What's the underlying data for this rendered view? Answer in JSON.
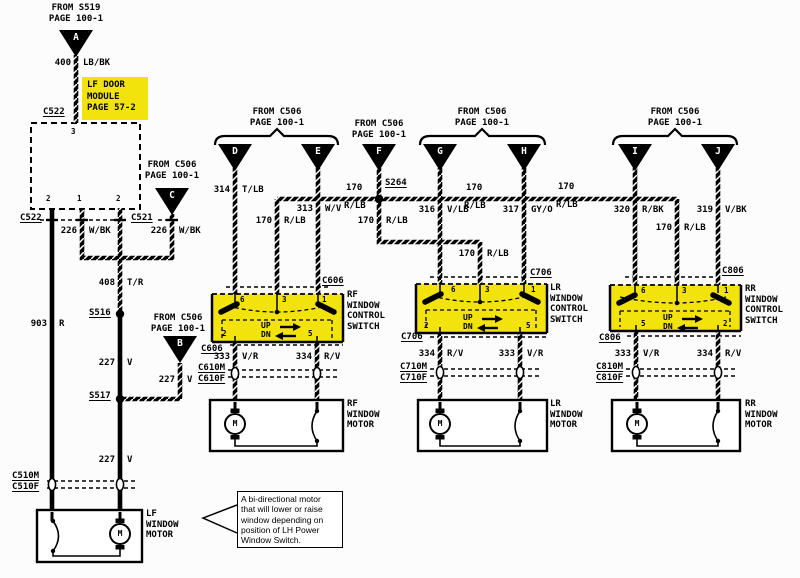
{
  "colors": {
    "highlight": "#F2E30D",
    "wire": "#000000",
    "background": "#fcfcfc"
  },
  "feeds": {
    "a": {
      "from": "FROM S519",
      "page": "PAGE 100-1",
      "letter": "A"
    },
    "c": {
      "from": "FROM C506",
      "page": "PAGE 100-1",
      "letter": "C"
    },
    "b": {
      "from": "FROM C506",
      "page": "PAGE 100-1",
      "letter": "B"
    },
    "de": {
      "from": "FROM C506",
      "page": "PAGE 100-1",
      "left": "D",
      "right": "E"
    },
    "f": {
      "from": "FROM C506",
      "page": "PAGE 100-1",
      "letter": "F"
    },
    "gh": {
      "from": "FROM C506",
      "page": "PAGE 100-1",
      "left": "G",
      "right": "H"
    },
    "ij": {
      "from": "FROM C506",
      "page": "PAGE 100-1",
      "left": "I",
      "right": "J"
    }
  },
  "module": {
    "line1": "LF DOOR",
    "line2": "MODULE",
    "line3": "PAGE 57-2",
    "conn_top": "C522",
    "pin_top": "3",
    "pin_b1": "2",
    "pin_b2": "1",
    "pin_b3": "2",
    "conn_bot_left": "C522",
    "conn_bot_right": "C521"
  },
  "splices": {
    "s516": "S516",
    "s517": "S517",
    "s264": "S264"
  },
  "wires": {
    "w400": {
      "num": "400",
      "code": "LB/BK"
    },
    "w226a": {
      "num": "226",
      "code": "W/BK"
    },
    "w226b": {
      "num": "226",
      "code": "W/BK"
    },
    "w408": {
      "num": "408",
      "code": "T/R"
    },
    "w903": {
      "num": "903",
      "code": "R"
    },
    "w227a": {
      "num": "227",
      "code": "V"
    },
    "w227b": {
      "num": "227",
      "code": "V"
    },
    "w227c": {
      "num": "227",
      "code": "V"
    },
    "w314": {
      "num": "314",
      "code": "T/LB"
    },
    "w313": {
      "num": "313",
      "code": "W/V"
    },
    "w170rf": {
      "num": "170",
      "code": "R/LB"
    },
    "w170s264l": {
      "num": "170",
      "code": "R/LB"
    },
    "w170s264d": {
      "num": "170",
      "code": "R/LB"
    },
    "w316": {
      "num": "316",
      "code": "V/LB"
    },
    "w170gh": {
      "num": "170",
      "code": "R/LB"
    },
    "w317": {
      "num": "317",
      "code": "GY/O"
    },
    "w170lr": {
      "num": "170",
      "code": "R/LB"
    },
    "w170hi": {
      "num": "170",
      "code": "R/LB"
    },
    "w320": {
      "num": "320",
      "code": "R/BK"
    },
    "w170rr": {
      "num": "170",
      "code": "R/LB"
    },
    "w319": {
      "num": "319",
      "code": "V/BK"
    },
    "w333rf": {
      "num": "333",
      "code": "V/R"
    },
    "w334rf": {
      "num": "334",
      "code": "R/V"
    },
    "w334lr": {
      "num": "334",
      "code": "R/V"
    },
    "w333lr": {
      "num": "333",
      "code": "V/R"
    },
    "w333rr": {
      "num": "333",
      "code": "V/R"
    },
    "w334rr": {
      "num": "334",
      "code": "R/V"
    }
  },
  "switches": {
    "rf": {
      "name1": "RF",
      "name2": "WINDOW",
      "name3": "CONTROL",
      "name4": "SWITCH",
      "conn_top": "C606",
      "conn_bot": "C606",
      "conn_m": "C610M",
      "conn_f": "C610F",
      "pins_top": [
        "6",
        "3",
        "1"
      ],
      "pin_bl": "2",
      "pin_br": "5",
      "up": "UP",
      "dn": "DN"
    },
    "lr": {
      "name1": "LR",
      "name2": "WINDOW",
      "name3": "CONTROL",
      "name4": "SWITCH",
      "conn_top": "C706",
      "conn_bot": "C706",
      "conn_m": "C710M",
      "conn_f": "C710F",
      "pins_top": [
        "6",
        "3",
        "1"
      ],
      "pin_bl": "2",
      "pin_br": "5",
      "up": "UP",
      "dn": "DN"
    },
    "rr": {
      "name1": "RR",
      "name2": "WINDOW",
      "name3": "CONTROL",
      "name4": "SWITCH",
      "conn_top": "C806",
      "conn_bot": "C806",
      "conn_m": "C810M",
      "conn_f": "C810F",
      "pins_top": [
        "6",
        "3",
        "1"
      ],
      "pin_bl": "5",
      "pin_br": "2",
      "up": "UP",
      "dn": "DN"
    }
  },
  "motors": {
    "lf": {
      "name1": "LF",
      "name2": "WINDOW",
      "name3": "MOTOR",
      "m": "M",
      "conn_m": "C510M",
      "conn_f": "C510F"
    },
    "rf": {
      "name1": "RF",
      "name2": "WINDOW",
      "name3": "MOTOR",
      "m": "M"
    },
    "lr": {
      "name1": "LR",
      "name2": "WINDOW",
      "name3": "MOTOR",
      "m": "M"
    },
    "rr": {
      "name1": "RR",
      "name2": "WINDOW",
      "name3": "MOTOR",
      "m": "M"
    }
  },
  "note": {
    "line1": "A bi-directional motor",
    "line2": "that will lower or raise",
    "line3": "window depending on",
    "line4": "position of LH Power",
    "line5": "Window Switch."
  }
}
